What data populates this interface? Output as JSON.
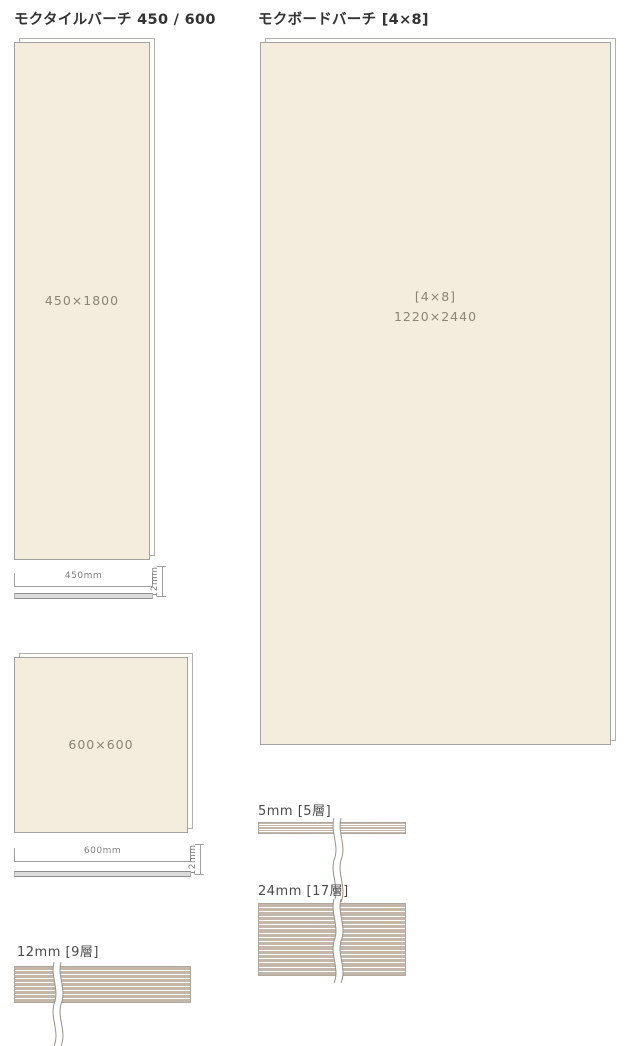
{
  "diagram": {
    "left": {
      "heading": "モクタイルバーチ 450 / 600",
      "tile_450": {
        "size_label": "450×1800",
        "width_dim": "450mm",
        "thickness_dim": "12mm"
      },
      "tile_600": {
        "size_label": "600×600",
        "width_dim": "600mm",
        "thickness_dim": "12mm"
      },
      "section_12mm": {
        "label": "12mm [9層]",
        "layer_count": 9
      }
    },
    "right": {
      "heading": "モクボードバーチ [4×8]",
      "board_4x8": {
        "size_label_line1": "[4×8]",
        "size_label_line2": "1220×2440"
      },
      "section_5mm": {
        "label": "5mm [5層]",
        "layer_count": 5
      },
      "section_24mm": {
        "label": "24mm [17層]",
        "layer_count": 17
      }
    },
    "colors": {
      "panel_fill": "#f4edde",
      "panel_border": "#a2a2a2",
      "layer_stripe": "#c2b7aa",
      "dim_line": "#a0a0a0",
      "heading_text": "#333333",
      "label_text": "#8c8474"
    }
  }
}
